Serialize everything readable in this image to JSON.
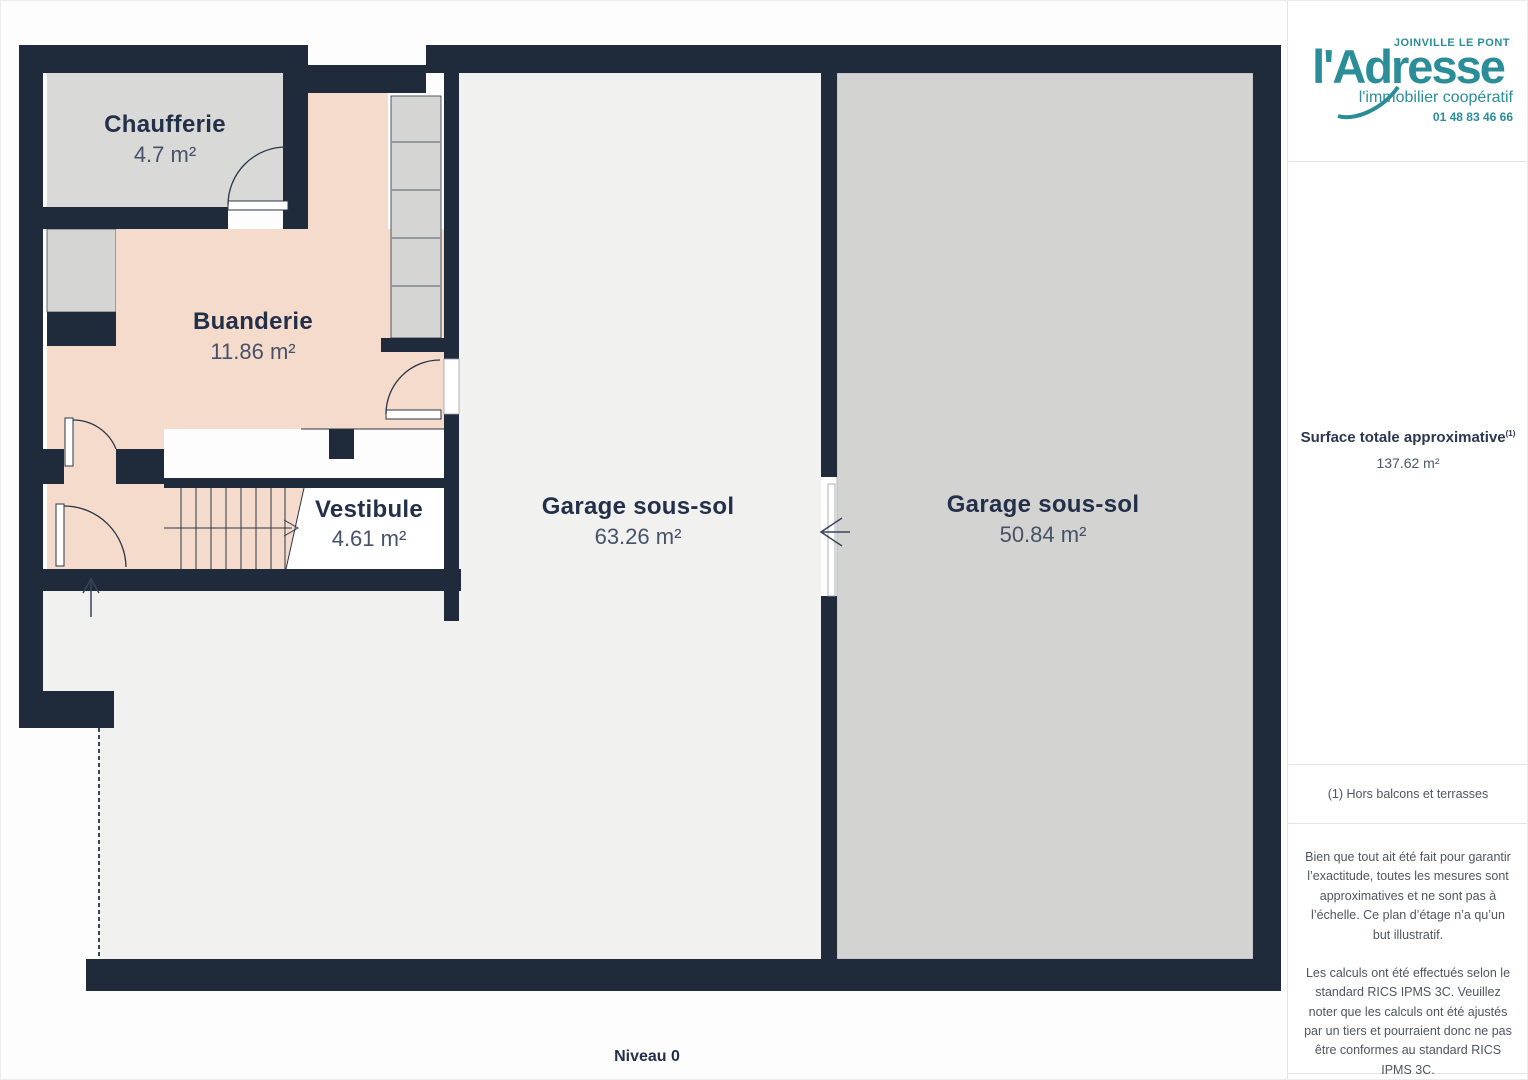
{
  "floorplan": {
    "level_label": "Niveau 0",
    "rooms": [
      {
        "name": "Chaufferie",
        "area": "4.7 m²"
      },
      {
        "name": "Buanderie",
        "area": "11.86 m²"
      },
      {
        "name": "Vestibule",
        "area": "4.61 m²"
      },
      {
        "name": "Garage sous-sol",
        "area": "63.26 m²"
      },
      {
        "name": "Garage sous-sol",
        "area": "50.84 m²"
      }
    ],
    "colors": {
      "wall": "#1f2a3a",
      "room_pink": "#f5dbcb",
      "room_gray": "#d6d6d5",
      "room_light": "#f1f1f0",
      "label_dark": "#24304a"
    }
  },
  "sidebar": {
    "brand": {
      "name": "l'Adresse",
      "location": "JOINVILLE LE PONT",
      "tagline": "l'immobilier coopératif",
      "phone": "01 48 83 46 66",
      "color": "#2a8d98"
    },
    "surface": {
      "label": "Surface totale approximative",
      "superscript": "(1)",
      "value": "137.62 m²"
    },
    "footnote": "(1) Hors balcons et terrasses",
    "disclaimer1": "Bien que tout ait été fait pour garantir l’exactitude, toutes les mesures sont approximatives et ne sont pas à l’échelle. Ce plan d’étage n’a qu’un but illustratif.",
    "disclaimer2": "Les calculs ont été effectués selon le standard RICS IPMS 3C. Veuillez noter que les calculs ont été ajustés par un tiers et pourraient donc ne pas être conformes au standard RICS IPMS 3C.",
    "watermark_brand": "GIRAFFE",
    "watermark_number": "360"
  }
}
